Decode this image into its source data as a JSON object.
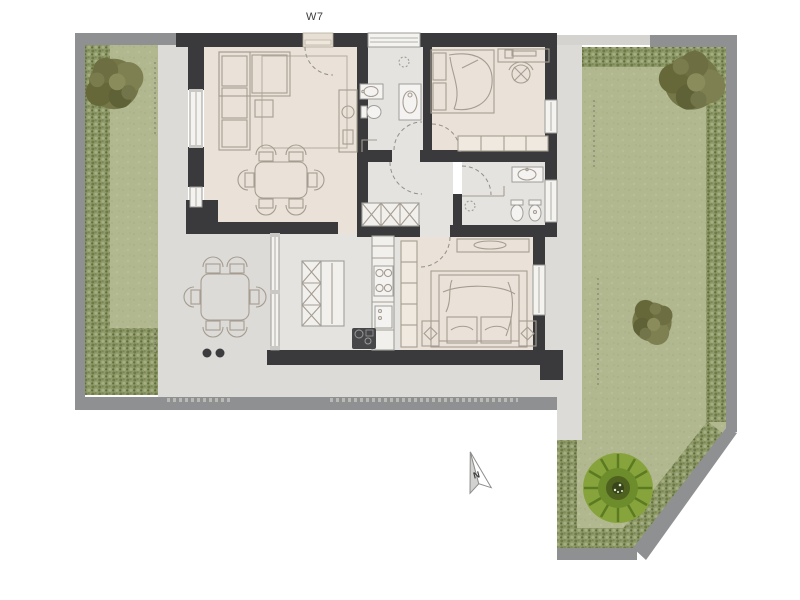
{
  "unit": {
    "label": "W7"
  },
  "compass": {
    "label": "N"
  },
  "palette": {
    "wall": "#3a3a3c",
    "boundary_wall": "#8f9092",
    "terrace": "#dcdbd7",
    "floor_warm": "#eae2d8",
    "floor_cool": "#e4e3e0",
    "lawn": "#b1b88f",
    "hedge": "#8e9a69",
    "tree_olive": "#757748",
    "tree_green": "#87a43c",
    "furniture_outline": "#a59d91"
  },
  "rooms": [
    {
      "id": "living-room",
      "floor": "warm",
      "furniture": [
        "corner-sofa",
        "rug",
        "side-table",
        "dining-table",
        "chairs-x6",
        "sideboard",
        "entry-door"
      ]
    },
    {
      "id": "bathroom-top",
      "floor": "cool",
      "furniture": [
        "washbasin",
        "toilet",
        "shower",
        "ceiling-light"
      ]
    },
    {
      "id": "bedroom-top",
      "floor": "warm",
      "furniture": [
        "bed",
        "desk",
        "office-chair",
        "wardrobe",
        "window"
      ]
    },
    {
      "id": "hallway",
      "floor": "cool",
      "furniture": [
        "closet-x3"
      ]
    },
    {
      "id": "bathroom-right",
      "floor": "cool",
      "furniture": [
        "washbasin",
        "toilet",
        "bidet",
        "shower-partition",
        "ceiling-light"
      ]
    },
    {
      "id": "kitchen",
      "floor": "cool",
      "furniture": [
        "island",
        "bar-stools",
        "counter",
        "hob",
        "oven",
        "sink-unit",
        "glass-wall"
      ]
    },
    {
      "id": "bedroom-bottom",
      "floor": "warm",
      "furniture": [
        "double-bed",
        "nightstand-x2",
        "dresser",
        "closet"
      ]
    },
    {
      "id": "terrace",
      "floor": "terrace",
      "furniture": [
        "outdoor-table",
        "chairs-x6",
        "planters-x2"
      ]
    }
  ],
  "garden": {
    "areas": [
      "lawn-left",
      "lawn-right"
    ],
    "vegetation": [
      "tree-top-left",
      "tree-top-right",
      "shrub-mid-right",
      "tree-bottom-green"
    ],
    "features": [
      "hedge-border",
      "boundary-wall",
      "plot-dotted-lines"
    ]
  }
}
